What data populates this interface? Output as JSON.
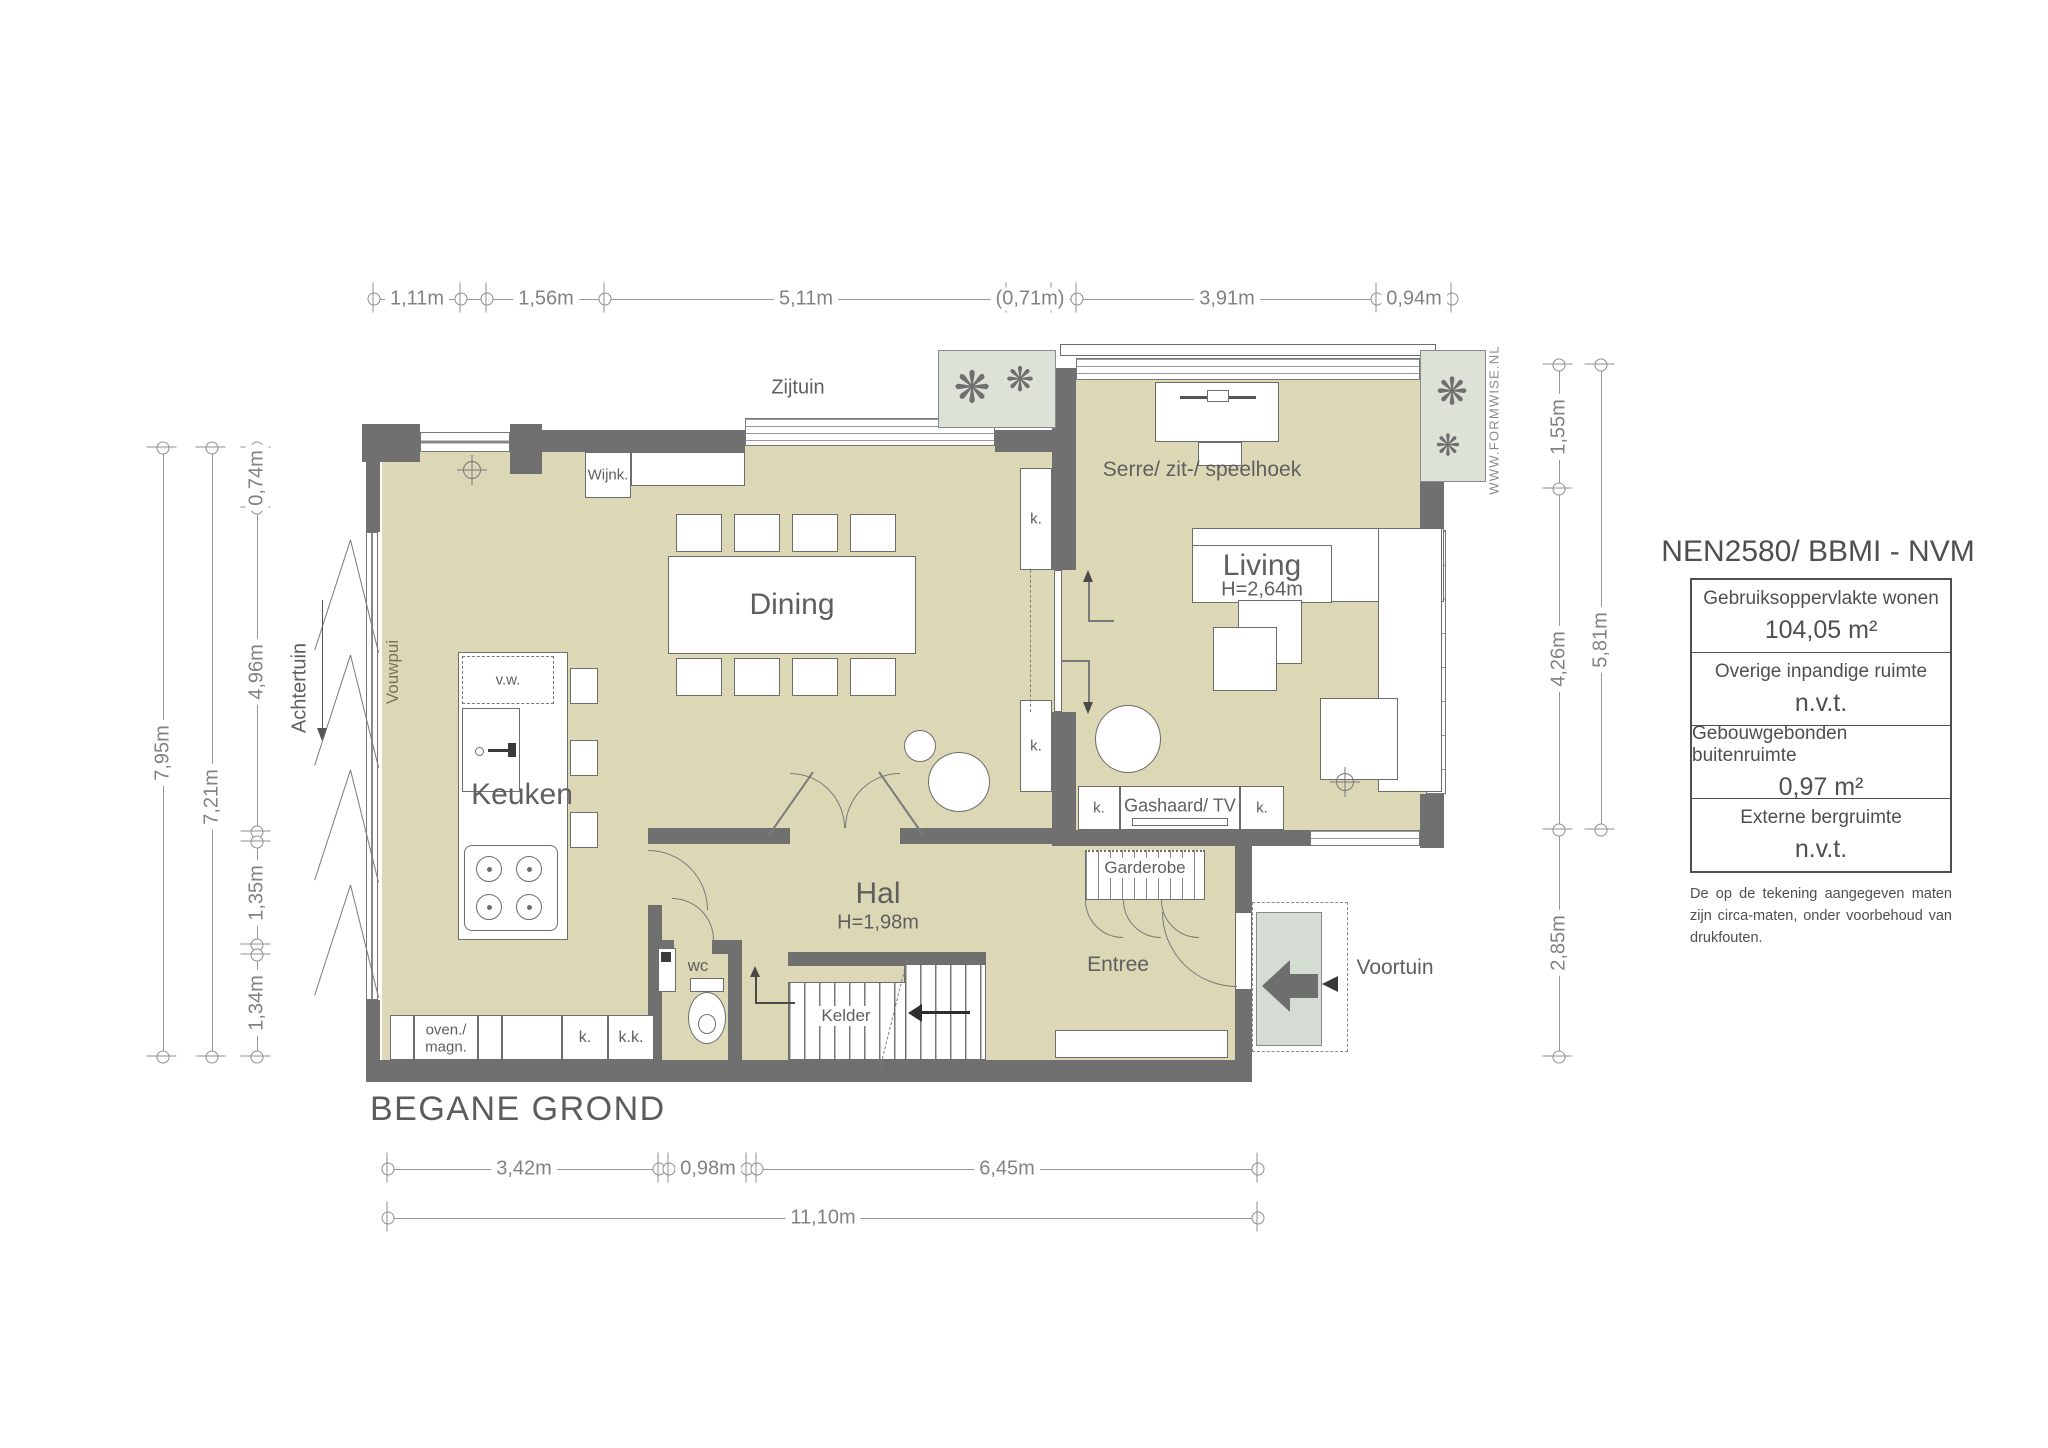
{
  "plan_title": "BEGANE GROND",
  "watermark": "WWW.FORMWISE.NL",
  "legend": {
    "title": "NEN2580/ BBMI - NVM",
    "rows": [
      {
        "label": "Gebruiksoppervlakte wonen",
        "value": "104,05 m²"
      },
      {
        "label": "Overige inpandige ruimte",
        "value": "n.v.t."
      },
      {
        "label": "Gebouwgebonden buitenruimte",
        "value": "0,97 m²"
      },
      {
        "label": "Externe bergruimte",
        "value": "n.v.t."
      }
    ],
    "disclaimer": "De op de tekening aangegeven maten zijn circa-maten, onder voorbehoud van drukfouten."
  },
  "labels": {
    "keuken": "Keuken",
    "dining": "Dining",
    "hal": "Hal",
    "hal_h": "H=1,98m",
    "living": "Living",
    "living_h": "H=2,64m",
    "serre": "Serre/ zit-/ speelhoek",
    "entree": "Entree",
    "wc": "wc",
    "kelder": "Kelder",
    "garderobe": "Garderobe",
    "gashaard": "Gashaard/ TV",
    "wijnk": "Wijnk.",
    "vw": "v.w.",
    "oven1": "oven./",
    "oven2": "magn.",
    "k": "k.",
    "kk": "k.k.",
    "zijtuin": "Zijtuin",
    "achtertuin": "Achtertuin",
    "voortuin": "Voortuin",
    "vouwpui": "Vouwpui"
  },
  "dimensions": {
    "top": [
      "1,11m",
      "1,56m",
      "5,11m",
      "(0,71m)",
      "3,91m",
      "0,94m"
    ],
    "bottom": [
      "3,42m",
      "0,98m",
      "6,45m"
    ],
    "bottom_total": "11,10m",
    "left_inner": [
      "0,74m",
      "4,96m",
      "1,35m",
      "1,34m"
    ],
    "left_mid": "7,21m",
    "left_outer": "7,95m",
    "right_inner": [
      "1,55m",
      "4,26m",
      "2,85m"
    ],
    "right_outer": "5,81m"
  },
  "colors": {
    "floor": "#dcd8b6",
    "wall": "#707070",
    "garden_green": "#dde2d6",
    "dim_line": "#979797",
    "text": "#5f5f5f"
  }
}
